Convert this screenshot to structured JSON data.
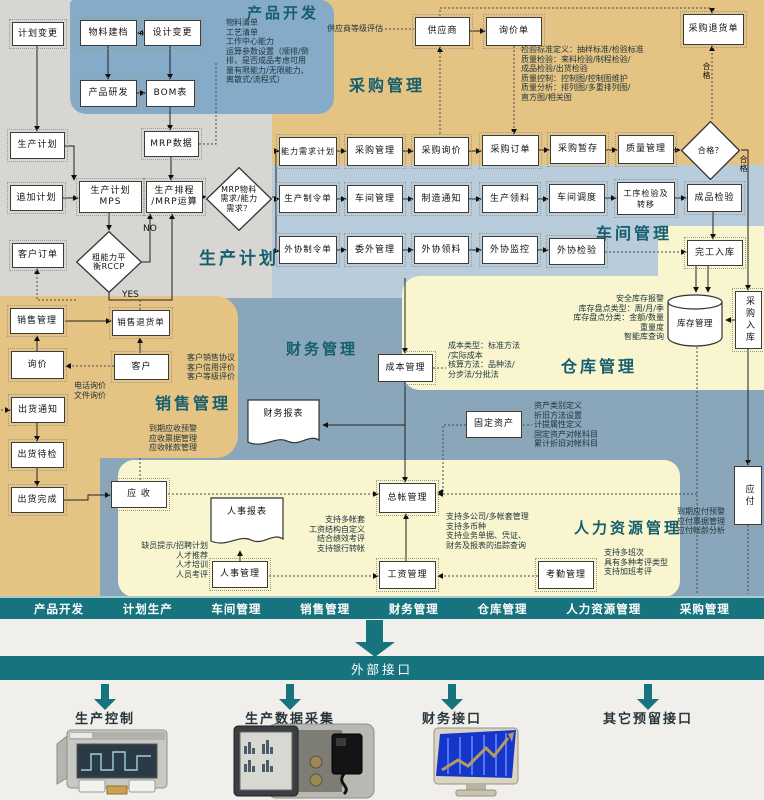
{
  "colors": {
    "teal": "#17747f",
    "tan": "#e5c382",
    "workshop_blue": "#b9ccdb",
    "finance_blue": "#8aa6ba",
    "product_blue": "#86abc9",
    "pale_yellow": "#f8f5cf",
    "gray": "#d7d6d2",
    "title_teal": "#155e6d"
  },
  "diagram": {
    "section_titles": [
      {
        "id": "product-dev",
        "label": "产品开发",
        "x": 247,
        "y": 2,
        "fs": 15
      },
      {
        "id": "purchasing",
        "label": "采购管理",
        "x": 349,
        "y": 72,
        "fs": 16
      },
      {
        "id": "production-planning",
        "label": "生产计划",
        "x": 199,
        "y": 244,
        "fs": 17
      },
      {
        "id": "workshop",
        "label": "车间管理",
        "x": 596,
        "y": 220,
        "fs": 16
      },
      {
        "id": "sales",
        "label": "销售管理",
        "x": 155,
        "y": 390,
        "fs": 16
      },
      {
        "id": "finance",
        "label": "财务管理",
        "x": 286,
        "y": 338,
        "fs": 15
      },
      {
        "id": "warehouse",
        "label": "仓库管理",
        "x": 561,
        "y": 353,
        "fs": 16
      },
      {
        "id": "hr",
        "label": "人力资源管理",
        "x": 574,
        "y": 517,
        "fs": 15
      }
    ],
    "nodes": [
      {
        "id": "plan-change",
        "shape": "rect",
        "label": "计划变更",
        "x": 12,
        "y": 22,
        "w": 52,
        "h": 24
      },
      {
        "id": "material-file",
        "shape": "rect",
        "label": "物料建档",
        "x": 80,
        "y": 20,
        "w": 57,
        "h": 26
      },
      {
        "id": "design-change",
        "shape": "rect",
        "label": "设计变更",
        "x": 144,
        "y": 20,
        "w": 57,
        "h": 26
      },
      {
        "id": "product-rd",
        "shape": "rect",
        "label": "产品研发",
        "x": 80,
        "y": 80,
        "w": 57,
        "h": 27
      },
      {
        "id": "bom",
        "shape": "rect",
        "label": "BOM表",
        "x": 146,
        "y": 80,
        "w": 49,
        "h": 27
      },
      {
        "id": "mrp-data",
        "shape": "rect",
        "label": "MRP数据",
        "x": 144,
        "y": 131,
        "w": 55,
        "h": 26
      },
      {
        "id": "prod-plan",
        "shape": "rect",
        "label": "生产计划",
        "x": 10,
        "y": 132,
        "w": 55,
        "h": 27
      },
      {
        "id": "add-plan",
        "shape": "rect",
        "label": "追加计划",
        "x": 10,
        "y": 185,
        "w": 53,
        "h": 26
      },
      {
        "id": "mps",
        "shape": "rect",
        "lines": [
          "生产计划",
          "MPS"
        ],
        "x": 79,
        "y": 181,
        "w": 63,
        "h": 32
      },
      {
        "id": "scheduling",
        "shape": "rect",
        "lines": [
          "生产排程",
          "/MRP运算"
        ],
        "x": 146,
        "y": 181,
        "w": 57,
        "h": 32
      },
      {
        "id": "mrp-decision",
        "shape": "diamond",
        "lines": [
          "MRP物料",
          "需求/能力",
          "需求？"
        ],
        "x": 206,
        "y": 167,
        "w": 66,
        "h": 64
      },
      {
        "id": "rccp",
        "shape": "diamond",
        "lines": [
          "粗能力平",
          "衡RCCP"
        ],
        "x": 76,
        "y": 231,
        "w": 66,
        "h": 62
      },
      {
        "id": "customer-order",
        "shape": "rect",
        "label": "客户订单",
        "x": 12,
        "y": 243,
        "w": 52,
        "h": 25
      },
      {
        "id": "supplier",
        "shape": "rect",
        "label": "供应商",
        "x": 415,
        "y": 17,
        "w": 55,
        "h": 29
      },
      {
        "id": "inquiry-form",
        "shape": "rect",
        "label": "询价单",
        "x": 486,
        "y": 17,
        "w": 56,
        "h": 29
      },
      {
        "id": "purchase-return",
        "shape": "rect",
        "label": "采购退货单",
        "x": 683,
        "y": 14,
        "w": 61,
        "h": 31
      },
      {
        "id": "capacity-req-plan",
        "shape": "rect",
        "label": "能力需求计划",
        "x": 279,
        "y": 137,
        "w": 58,
        "h": 29,
        "fs": 8
      },
      {
        "id": "purchase-mgmt",
        "shape": "rect",
        "label": "采购管理",
        "x": 347,
        "y": 137,
        "w": 56,
        "h": 29
      },
      {
        "id": "purchase-inquiry",
        "shape": "rect",
        "label": "采购询价",
        "x": 414,
        "y": 137,
        "w": 55,
        "h": 29
      },
      {
        "id": "purchase-order",
        "shape": "rect",
        "label": "采购订单",
        "x": 482,
        "y": 135,
        "w": 57,
        "h": 31
      },
      {
        "id": "purchase-temp",
        "shape": "rect",
        "label": "采购暂存",
        "x": 550,
        "y": 135,
        "w": 56,
        "h": 29
      },
      {
        "id": "quality-mgmt",
        "shape": "rect",
        "label": "质量管理",
        "x": 618,
        "y": 135,
        "w": 56,
        "h": 29
      },
      {
        "id": "qualified-decision",
        "shape": "diamond",
        "lines": [
          "合格？"
        ],
        "x": 681,
        "y": 121,
        "w": 59,
        "h": 59
      },
      {
        "id": "prod-work-order",
        "shape": "rect",
        "label": "生产制令单",
        "x": 279,
        "y": 185,
        "w": 58,
        "h": 28,
        "fs": 8.5
      },
      {
        "id": "workshop-mgmt",
        "shape": "rect",
        "label": "车间管理",
        "x": 347,
        "y": 185,
        "w": 56,
        "h": 28
      },
      {
        "id": "mfg-notice",
        "shape": "rect",
        "label": "制造通知",
        "x": 414,
        "y": 185,
        "w": 55,
        "h": 28
      },
      {
        "id": "prod-picking",
        "shape": "rect",
        "label": "生产领料",
        "x": 482,
        "y": 185,
        "w": 56,
        "h": 28
      },
      {
        "id": "workshop-dispatch",
        "shape": "rect",
        "label": "车间调度",
        "x": 549,
        "y": 184,
        "w": 56,
        "h": 29
      },
      {
        "id": "process-inspection",
        "shape": "rect",
        "lines": [
          "工序检验及",
          "转移"
        ],
        "x": 617,
        "y": 182,
        "w": 58,
        "h": 33,
        "fs": 8
      },
      {
        "id": "product-inspection",
        "shape": "rect",
        "label": "成品检验",
        "x": 687,
        "y": 184,
        "w": 55,
        "h": 28
      },
      {
        "id": "outsource-work-order",
        "shape": "rect",
        "label": "外协制令单",
        "x": 279,
        "y": 236,
        "w": 58,
        "h": 28,
        "fs": 8.5
      },
      {
        "id": "outsource-mgmt",
        "shape": "rect",
        "label": "委外管理",
        "x": 347,
        "y": 236,
        "w": 56,
        "h": 28
      },
      {
        "id": "outsource-picking",
        "shape": "rect",
        "label": "外协领料",
        "x": 414,
        "y": 236,
        "w": 55,
        "h": 28
      },
      {
        "id": "outsource-monitor",
        "shape": "rect",
        "label": "外协监控",
        "x": 482,
        "y": 236,
        "w": 56,
        "h": 28
      },
      {
        "id": "outsource-inspection",
        "shape": "rect",
        "label": "外协检验",
        "x": 549,
        "y": 238,
        "w": 56,
        "h": 27
      },
      {
        "id": "finish-instock",
        "shape": "rect",
        "label": "完工入库",
        "x": 687,
        "y": 240,
        "w": 56,
        "h": 26
      },
      {
        "id": "inventory-mgmt",
        "shape": "cylinder",
        "label": "库存管理",
        "x": 666,
        "y": 293,
        "w": 58,
        "h": 54
      },
      {
        "id": "purchase-instock",
        "shape": "vrect",
        "label": "采购入库",
        "x": 735,
        "y": 291,
        "w": 27,
        "h": 58
      },
      {
        "id": "sales-mgmt",
        "shape": "rect",
        "label": "销售管理",
        "x": 10,
        "y": 308,
        "w": 54,
        "h": 26
      },
      {
        "id": "sales-return",
        "shape": "rect",
        "label": "销售退货单",
        "x": 112,
        "y": 310,
        "w": 58,
        "h": 26,
        "fs": 8.5
      },
      {
        "id": "inquiry",
        "shape": "rect",
        "label": "询价",
        "x": 11,
        "y": 351,
        "w": 53,
        "h": 28
      },
      {
        "id": "customer",
        "shape": "rect",
        "label": "客户",
        "x": 114,
        "y": 354,
        "w": 55,
        "h": 26
      },
      {
        "id": "ship-notice",
        "shape": "rect",
        "label": "出货通知",
        "x": 11,
        "y": 397,
        "w": 54,
        "h": 26
      },
      {
        "id": "ship-inspect",
        "shape": "rect",
        "label": "出货待检",
        "x": 11,
        "y": 442,
        "w": 53,
        "h": 26
      },
      {
        "id": "ship-done",
        "shape": "rect",
        "label": "出货完成",
        "x": 11,
        "y": 487,
        "w": 53,
        "h": 26
      },
      {
        "id": "cost-mgmt",
        "shape": "rect",
        "label": "成本管理",
        "x": 378,
        "y": 354,
        "w": 55,
        "h": 28
      },
      {
        "id": "finance-report",
        "shape": "doc",
        "label": "财务报表",
        "x": 246,
        "y": 398,
        "w": 75,
        "h": 54
      },
      {
        "id": "fixed-asset",
        "shape": "rect",
        "label": "固定资产",
        "x": 466,
        "y": 411,
        "w": 56,
        "h": 27
      },
      {
        "id": "ledger-mgmt",
        "shape": "rect",
        "label": "总帐管理",
        "x": 379,
        "y": 483,
        "w": 57,
        "h": 30
      },
      {
        "id": "receivable",
        "shape": "rect",
        "label": "应  收",
        "x": 111,
        "y": 481,
        "w": 56,
        "h": 27
      },
      {
        "id": "payable",
        "shape": "vrect",
        "label": "应付",
        "x": 734,
        "y": 466,
        "w": 28,
        "h": 59
      },
      {
        "id": "hr-report",
        "shape": "doc",
        "label": "人事报表",
        "x": 209,
        "y": 496,
        "w": 76,
        "h": 55
      },
      {
        "id": "hr-mgmt",
        "shape": "rect",
        "label": "人事管理",
        "x": 212,
        "y": 561,
        "w": 56,
        "h": 27
      },
      {
        "id": "payroll-mgmt",
        "shape": "rect",
        "label": "工资管理",
        "x": 379,
        "y": 561,
        "w": 57,
        "h": 28
      },
      {
        "id": "attendance-mgmt",
        "shape": "rect",
        "label": "考勤管理",
        "x": 538,
        "y": 561,
        "w": 56,
        "h": 28
      }
    ],
    "notes": [
      {
        "id": "product-dev-note",
        "x": 226,
        "y": 18,
        "w": 96,
        "align": "left",
        "wrap": true,
        "lines": [
          "物料清单",
          "工艺清单",
          "工作中心能力",
          "运算参数设置（顺排/倒",
          "排，是否成品考虑可用",
          "量有限能力/无限能力、",
          "离散式/流程式）"
        ]
      },
      {
        "id": "supplier-eval-note",
        "x": 327,
        "y": 24,
        "w": 54,
        "align": "left",
        "lines": [
          "供应商等级评估"
        ]
      },
      {
        "id": "quality-note",
        "x": 521,
        "y": 45,
        "w": 124,
        "align": "left",
        "lines": [
          "检验标准定义：抽样标准/检验标准",
          "质量检验：来料检验/制程检验/",
          "成品检验/出货检验",
          "质量控制：控制图/控制图维护",
          "质量分析：排列图/多重排列图/",
          "直方图/相关图"
        ]
      },
      {
        "id": "customer-note",
        "x": 187,
        "y": 353,
        "w": 52,
        "align": "left",
        "lines": [
          "客户销售协议",
          "客户信用评价",
          "客户等级评价"
        ]
      },
      {
        "id": "inquiry-method-note",
        "x": 74,
        "y": 381,
        "w": 36,
        "align": "left",
        "lines": [
          "电话询价",
          "文件询价"
        ]
      },
      {
        "id": "receivable-note",
        "x": 149,
        "y": 424,
        "w": 54,
        "align": "left",
        "lines": [
          "到期应收预警",
          "应收票据管理",
          "应收帐款管理"
        ]
      },
      {
        "id": "inventory-note",
        "x": 566,
        "y": 294,
        "w": 98,
        "align": "right",
        "lines": [
          "安全库存报警",
          "库存盘点类型：周/月/季",
          "库存盘点分类：金额/数量",
          "重量度",
          "智能库查询"
        ]
      },
      {
        "id": "asset-note",
        "x": 534,
        "y": 401,
        "w": 86,
        "align": "left",
        "lines": [
          "资产类别定义",
          "折旧方法设置",
          "计提属性定义",
          "固定资产对帐科目",
          "累计折旧对帐科目"
        ]
      },
      {
        "id": "cost-note",
        "x": 448,
        "y": 341,
        "w": 66,
        "align": "left",
        "lines": [
          "成本类型：标准方法",
          "/实际成本",
          "核算方法：品种法/",
          "分步法/分批法"
        ]
      },
      {
        "id": "payable-note",
        "x": 677,
        "y": 507,
        "w": 58,
        "align": "left",
        "lines": [
          "到期应付预警",
          "应付票据管理",
          "应付帐龄分析"
        ]
      },
      {
        "id": "recruit-note",
        "x": 128,
        "y": 541,
        "w": 80,
        "align": "right",
        "lines": [
          "缺员提示/招聘计划",
          "人才推荐",
          "人才培训",
          "人员考评"
        ]
      },
      {
        "id": "payroll-note",
        "x": 305,
        "y": 515,
        "w": 60,
        "align": "right",
        "lines": [
          "支持多帐套",
          "工资结构自定义",
          "结合绩效考评",
          "支持银行转帐"
        ]
      },
      {
        "id": "ledger-note",
        "x": 446,
        "y": 512,
        "w": 92,
        "align": "left",
        "lines": [
          "支持多公司/多帐套管理",
          "支持多币种",
          "支持业务单据、凭证、",
          "财务及报表的追踪查询"
        ]
      },
      {
        "id": "attendance-note",
        "x": 604,
        "y": 548,
        "w": 78,
        "align": "left",
        "lines": [
          "支持多班次",
          "具有多种考评类型",
          "支持加班考评"
        ]
      }
    ],
    "labels": [
      {
        "id": "no-label",
        "text": "NO",
        "x": 143,
        "y": 224
      },
      {
        "id": "yes-label",
        "text": "YES",
        "x": 122,
        "y": 290
      },
      {
        "id": "qualified-up-label",
        "text": "合格",
        "x": 701,
        "y": 62,
        "vert": true
      },
      {
        "id": "qualified-down-label",
        "text": "合格",
        "x": 738,
        "y": 155,
        "vert": true
      }
    ]
  },
  "bottom_nav": {
    "items": [
      "产品开发",
      "计划生产",
      "车间管理",
      "销售管理",
      "财务管理",
      "仓库管理",
      "人力资源管理",
      "采购管理"
    ]
  },
  "interface_bar": {
    "label": "外部接口"
  },
  "external_links": [
    {
      "id": "production-control",
      "label": "生产控制",
      "cx": 105
    },
    {
      "id": "production-data-acquisition",
      "label": "生产数据采集",
      "cx": 290
    },
    {
      "id": "finance-interface",
      "label": "财务接口",
      "cx": 452
    },
    {
      "id": "other-reserved-interface",
      "label": "其它预留接口",
      "cx": 648
    }
  ]
}
